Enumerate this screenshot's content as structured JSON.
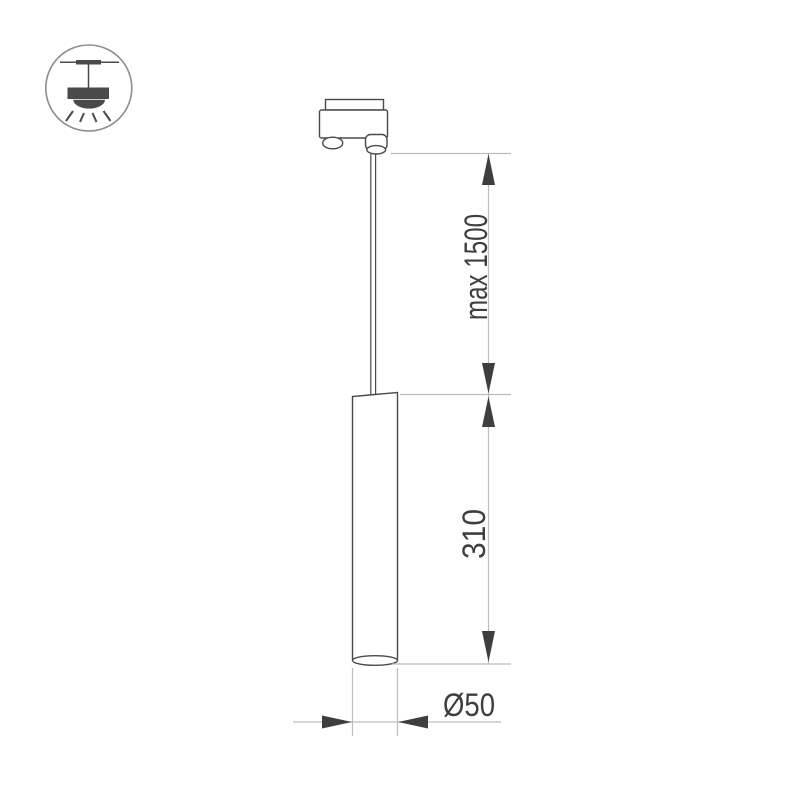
{
  "figure": {
    "kind": "technical-dimension-drawing",
    "subject": "track-mounted pendant tube luminaire"
  },
  "legend_icon": {
    "name": "pendant-lamp-mounting-icon"
  },
  "dimensions": {
    "suspension_length": "max 1500",
    "body_length": "310",
    "body_diameter": "Ø50"
  },
  "colors": {
    "background": "#ffffff",
    "object_outline": "#4a4a4a",
    "dimension_line": "#bdbdbd",
    "arrow": "#3e3e3e",
    "text": "#3e3e3e",
    "icon_circle": "#8c8c8c"
  }
}
